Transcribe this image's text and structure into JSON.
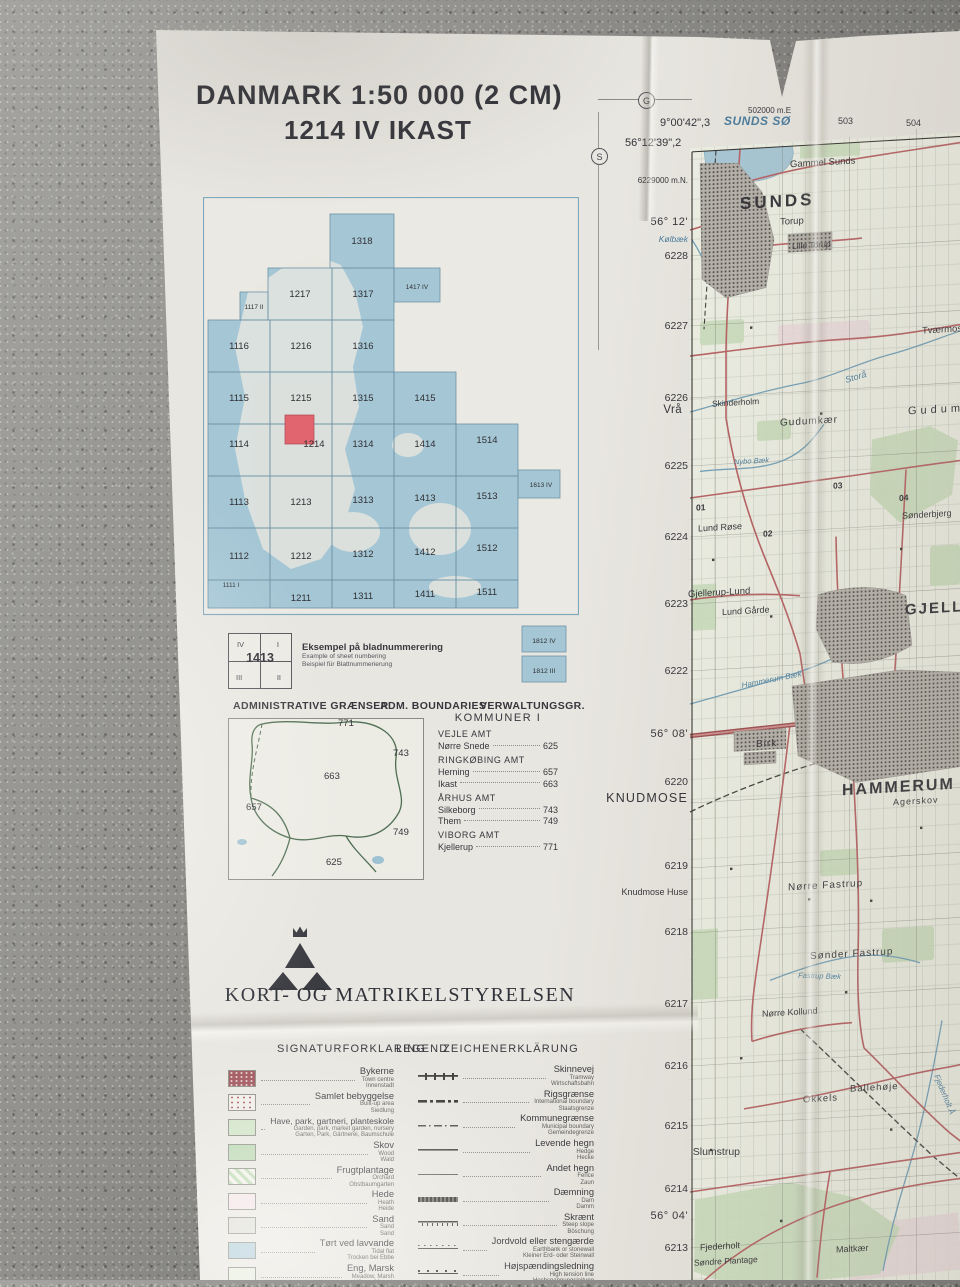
{
  "surface": {
    "type": "concrete pavement"
  },
  "title": {
    "line1": "DANMARK 1:50 000 (2 CM)",
    "line2": "1214 IV  IKAST"
  },
  "north_indicators": {
    "g": "G",
    "s": "S"
  },
  "index_map": {
    "cells": {
      "c1318": "1318",
      "c1217": "1217",
      "c1317": "1317",
      "c1417": "1417 IV",
      "c1117": "1117 II",
      "c1116": "1116",
      "c1216": "1216",
      "c1316": "1316",
      "c1115": "1115",
      "c1215": "1215",
      "c1315": "1315",
      "c1415": "1415",
      "c1114": "1114",
      "c1214": "1214",
      "c1314": "1314",
      "c1414": "1414",
      "c1514": "1514",
      "c1113": "1113",
      "c1213": "1213",
      "c1313": "1313",
      "c1413": "1413",
      "c1513": "1513",
      "c1613": "1613 IV",
      "c1112": "1112",
      "c1212": "1212",
      "c1312": "1312",
      "c1412": "1412",
      "c1512": "1512",
      "c1111": "1111 I",
      "c1211": "1211",
      "c1311": "1311",
      "c1411": "1411",
      "c1511": "1511",
      "c1812iv": "1812 IV",
      "c1812iii": "1812 III"
    },
    "highlighted_cell": "1214",
    "example": {
      "q_iv": "IV",
      "q_i": "I",
      "q_iii": "III",
      "q_ii": "II",
      "center": "1413",
      "caption_da": "Eksempel på bladnummerering",
      "caption_en": "Example of sheet numbering",
      "caption_de": "Beispiel für Blattnummerierung"
    }
  },
  "admin": {
    "header_da": "ADMINISTRATIVE GRÆNSER",
    "header_en": "ADM. BOUNDARIES",
    "header_de": "VERWALTUNGSGR.",
    "map_numbers": {
      "n771": "771",
      "n743": "743",
      "n663": "663",
      "n657": "657",
      "n749": "749",
      "n625": "625"
    },
    "kommuner_title": "KOMMUNER I",
    "groups": [
      {
        "amt": "VEJLE AMT",
        "entries": [
          {
            "name": "Nørre Snede",
            "code": "625"
          }
        ]
      },
      {
        "amt": "RINGKØBING AMT",
        "entries": [
          {
            "name": "Herning",
            "code": "657"
          },
          {
            "name": "Ikast",
            "code": "663"
          }
        ]
      },
      {
        "amt": "ÅRHUS AMT",
        "entries": [
          {
            "name": "Silkeborg",
            "code": "743"
          },
          {
            "name": "Them",
            "code": "749"
          }
        ]
      },
      {
        "amt": "VIBORG AMT",
        "entries": [
          {
            "name": "Kjellerup",
            "code": "771"
          }
        ]
      }
    ]
  },
  "publisher": "KORT- OG MATRIKELSTYRELSEN",
  "legend": {
    "header_da": "SIGNATURFORKLARING",
    "header_en": "LEGEND",
    "header_de": "ZEICHENERKLÄRUNG",
    "left": [
      {
        "da": "Bykerne",
        "en": "Town centre",
        "de": "Innenstadt"
      },
      {
        "da": "Samlet bebyggelse",
        "en": "Built-up area",
        "de": "Siedlung"
      },
      {
        "da": "Have, park, gartneri, planteskole",
        "en": "Garden, park, market garden, nursery",
        "de": "Garten, Park, Gärtnerei, Baumschule"
      },
      {
        "da": "Skov",
        "en": "Wood",
        "de": "Wald"
      },
      {
        "da": "Frugtplantage",
        "en": "Orchard",
        "de": "Obstbaumgarten"
      },
      {
        "da": "Hede",
        "en": "Heath",
        "de": "Heide"
      },
      {
        "da": "Sand",
        "en": "Sand",
        "de": "Sand"
      },
      {
        "da": "Tørt ved lavvande",
        "en": "Tidal flat",
        "de": "Trocken bei Ebbe"
      },
      {
        "da": "Eng, Marsk",
        "en": "Meadow, Marsh",
        "de": "Wiese, Marsch"
      }
    ],
    "right": [
      {
        "da": "Skinnevej",
        "en": "Tramway",
        "de": "Wirtschaftsbahn"
      },
      {
        "da": "Rigsgrænse",
        "en": "International boundary",
        "de": "Staatsgrenze"
      },
      {
        "da": "Kommunegrænse",
        "en": "Municipal boundary",
        "de": "Gemeindegrenze"
      },
      {
        "da": "Levende hegn",
        "en": "Hedge",
        "de": "Hecke"
      },
      {
        "da": "Andet hegn",
        "en": "Fence",
        "de": "Zaun"
      },
      {
        "da": "Dæmning",
        "en": "Dam",
        "de": "Damm"
      },
      {
        "da": "Skrænt",
        "en": "Steep slope",
        "de": "Böschung"
      },
      {
        "da": "Jordvold eller stengærde",
        "en": "Earthbank or stonewall",
        "de": "Kleiner Erd- oder Steinwall"
      },
      {
        "da": "Højspændingsledning",
        "en": "High tension line",
        "de": "Hochspannungsleitung"
      }
    ]
  },
  "map": {
    "top": {
      "easting": "502000 m.E",
      "e2": "503",
      "e3": "504",
      "lon": "9°00'42\",3",
      "lake": "SUNDS SØ",
      "lat": "56°12'39\",2"
    },
    "west": [
      {
        "t": "6229000 m.N."
      },
      {
        "t": "56° 12'"
      },
      {
        "t": "Kølbæk"
      },
      {
        "t": "6228"
      },
      {
        "t": "6227"
      },
      {
        "t": "6226"
      },
      {
        "t": "Vrå"
      },
      {
        "t": "6225"
      },
      {
        "t": "6224"
      },
      {
        "t": "6223"
      },
      {
        "t": "6222"
      },
      {
        "t": "56° 08'"
      },
      {
        "t": "6220"
      },
      {
        "t": "KNUDMOSE"
      },
      {
        "t": "6219"
      },
      {
        "t": "Knudmose Huse"
      },
      {
        "t": "6218"
      },
      {
        "t": "6217"
      },
      {
        "t": "6216"
      },
      {
        "t": "6215"
      },
      {
        "t": "Slumstrup"
      },
      {
        "t": "6214"
      },
      {
        "t": "56° 04'"
      },
      {
        "t": "6213"
      }
    ],
    "labels": {
      "sunds": "SUNDS",
      "gammel_sunds": "Gammel Sunds",
      "torup": "Torup",
      "lille_torup": "Lille Torup",
      "tvaermose": "Tværmose",
      "skinderholm": "Skinderholm",
      "gudumkaer": "Gudumkær",
      "gudum": "Gudum",
      "storaa": "Storå",
      "nybo_baek": "Nybo Bæk",
      "soenderbjerg": "Sønderbjerg",
      "lund_roese": "Lund Røse",
      "gjellerup_lund": "Gjellerup-Lund",
      "lund_gaarde": "Lund Gårde",
      "gjellerup": "GJELLERUP",
      "hammerum_baek": "Hammerum Bæk",
      "birk": "Birk",
      "hammerum": "HAMMERUM",
      "agerskov": "Agerskov",
      "noerre_fastrup": "Nørre Fastrup",
      "soender_fastrup": "Sønder Fastrup",
      "fastrup_baek": "Fastrup Bæk",
      "noerre_kollund": "Nørre Kollund",
      "okkels": "Okkels",
      "ballehoeje": "Ballehøje",
      "fjederholt_aa": "Fjederholt Å",
      "fjederholt": "Fjederholt",
      "soendre_plantage": "Søndre Plantage",
      "maltkaer": "Maltkær",
      "g01": "01",
      "g02": "02",
      "g03": "03",
      "g04": "04"
    }
  },
  "colors": {
    "road": "#b65f60",
    "water": "#6f9fb8",
    "woodland": "#c9ddbb",
    "urban": "#b5b2ab",
    "sheet_highlight": "#e0656e",
    "index_sea": "#a5c6d5"
  }
}
